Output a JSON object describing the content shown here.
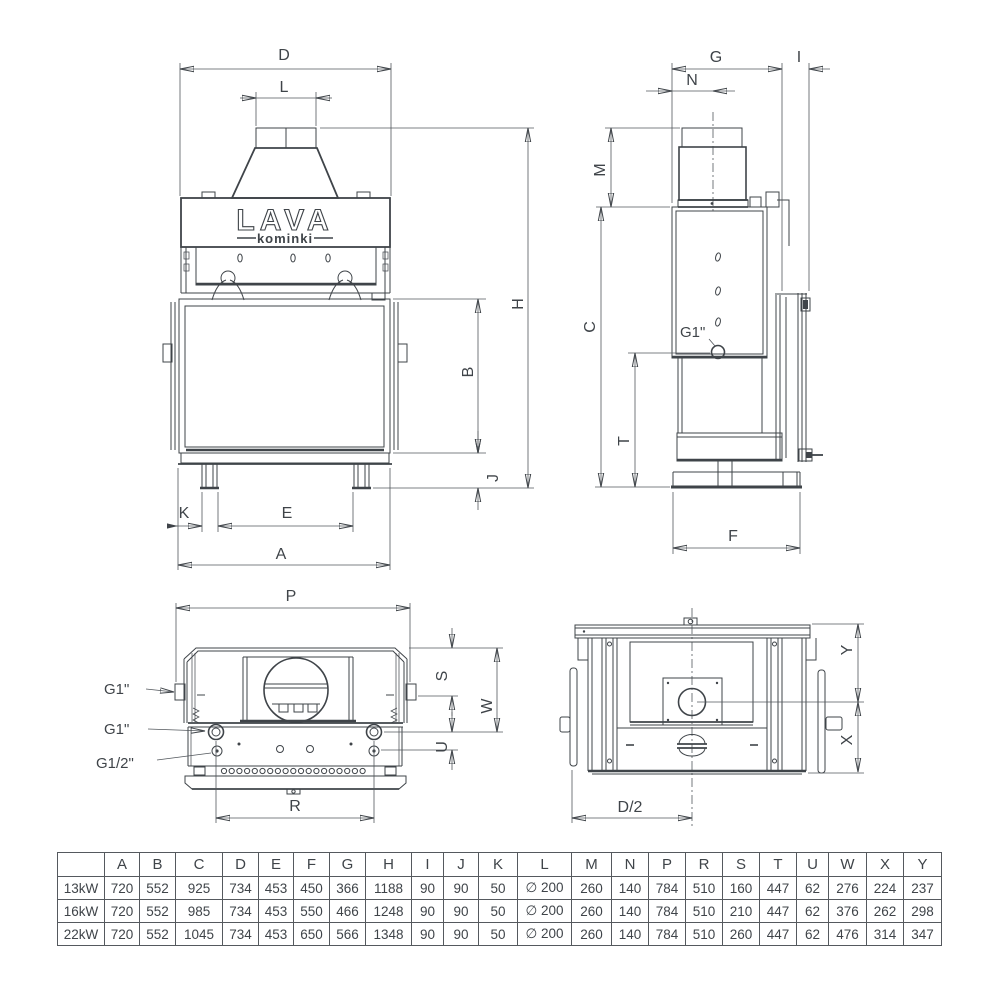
{
  "logo": {
    "brand": "LAVA",
    "sub": "kominki"
  },
  "dims": {
    "D": "D",
    "L": "L",
    "H": "H",
    "B": "B",
    "J": "J",
    "K": "K",
    "E": "E",
    "A": "A",
    "G": "G",
    "N": "N",
    "I": "I",
    "M": "M",
    "C": "C",
    "T": "T",
    "F": "F",
    "P": "P",
    "S": "S",
    "W": "W",
    "U": "U",
    "R": "R",
    "Y": "Y",
    "X": "X",
    "D2": "D/2"
  },
  "ports": {
    "g1": "G1\"",
    "g12": "G1/2\""
  },
  "table": {
    "header": [
      "",
      "A",
      "B",
      "C",
      "D",
      "E",
      "F",
      "G",
      "H",
      "I",
      "J",
      "K",
      "L",
      "M",
      "N",
      "P",
      "R",
      "S",
      "T",
      "U",
      "W",
      "X",
      "Y"
    ],
    "rows": [
      {
        "label": "13kW",
        "values": [
          "720",
          "552",
          "925",
          "734",
          "453",
          "450",
          "366",
          "1188",
          "90",
          "90",
          "50",
          "∅ 200",
          "260",
          "140",
          "784",
          "510",
          "160",
          "447",
          "62",
          "276",
          "224",
          "237"
        ]
      },
      {
        "label": "16kW",
        "values": [
          "720",
          "552",
          "985",
          "734",
          "453",
          "550",
          "466",
          "1248",
          "90",
          "90",
          "50",
          "∅ 200",
          "260",
          "140",
          "784",
          "510",
          "210",
          "447",
          "62",
          "376",
          "262",
          "298"
        ]
      },
      {
        "label": "22kW",
        "values": [
          "720",
          "552",
          "1045",
          "734",
          "453",
          "650",
          "566",
          "1348",
          "90",
          "90",
          "50",
          "∅ 200",
          "260",
          "140",
          "784",
          "510",
          "260",
          "447",
          "62",
          "476",
          "314",
          "347"
        ]
      }
    ]
  }
}
